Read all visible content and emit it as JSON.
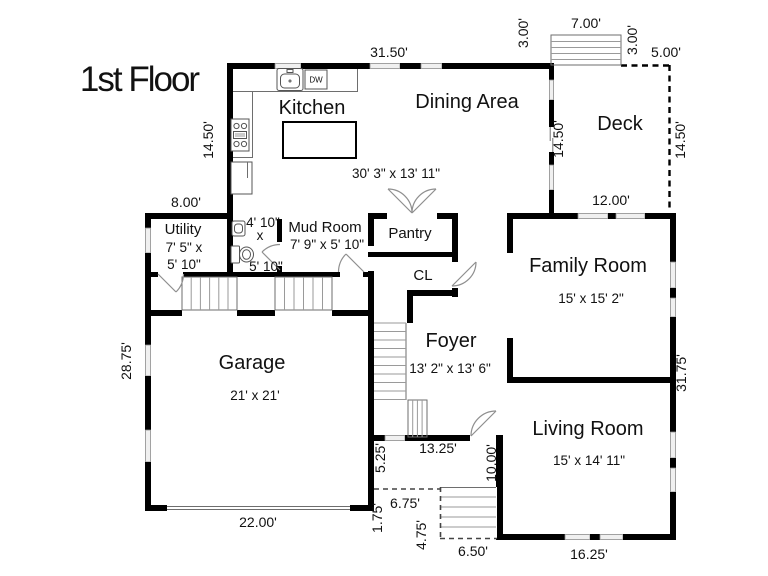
{
  "title": "1st Floor",
  "colors": {
    "walls": "#000000",
    "background": "#ffffff"
  },
  "rooms": {
    "kitchen": {
      "name": "Kitchen"
    },
    "dining": {
      "name": "Dining Area"
    },
    "kitchen_dining_size": "30' 3\" x 13' 11\"",
    "deck": {
      "name": "Deck"
    },
    "family": {
      "name": "Family Room",
      "size": "15' x 15' 2\""
    },
    "living": {
      "name": "Living Room",
      "size": "15' x 14' 11\""
    },
    "foyer": {
      "name": "Foyer",
      "size": "13' 2\" x 13' 6\""
    },
    "garage": {
      "name": "Garage",
      "size": "21' x 21'"
    },
    "utility": {
      "name": "Utility",
      "size_line1": "7' 5\" x",
      "size_line2": "5' 10\""
    },
    "bath": {
      "size_line1": "4' 10\"",
      "size_line2": "x",
      "size_line3": "5' 10\""
    },
    "mud": {
      "name": "Mud Room",
      "size": "7' 9\" x 5' 10\""
    },
    "pantry": {
      "name": "Pantry"
    },
    "closet": {
      "name": "CL"
    }
  },
  "fixtures": {
    "dishwasher_label": "DW"
  },
  "dimensions": {
    "top_wall": "31.50'",
    "deck_steps_width": "7.00'",
    "deck_steps_depth_left": "3.00'",
    "deck_steps_depth_right": "3.00'",
    "deck_top_right": "5.00'",
    "kitchen_height": "14.50'",
    "deck_left_height": "14.50'",
    "deck_right_height": "14.50'",
    "utility_width": "8.00'",
    "deck_bottom": "12.00'",
    "left_wall": "28.75'",
    "right_wall": "31.75'",
    "garage_bottom": "22.00'",
    "living_bottom": "16.25'",
    "entry_wall": "13.25'",
    "porch_depth": "5.25'",
    "entry_side": "10.00'",
    "porch_width": "6.75'",
    "porch_step": "1.75'",
    "front_steps_height": "4.75'",
    "front_steps_width": "6.50'"
  }
}
